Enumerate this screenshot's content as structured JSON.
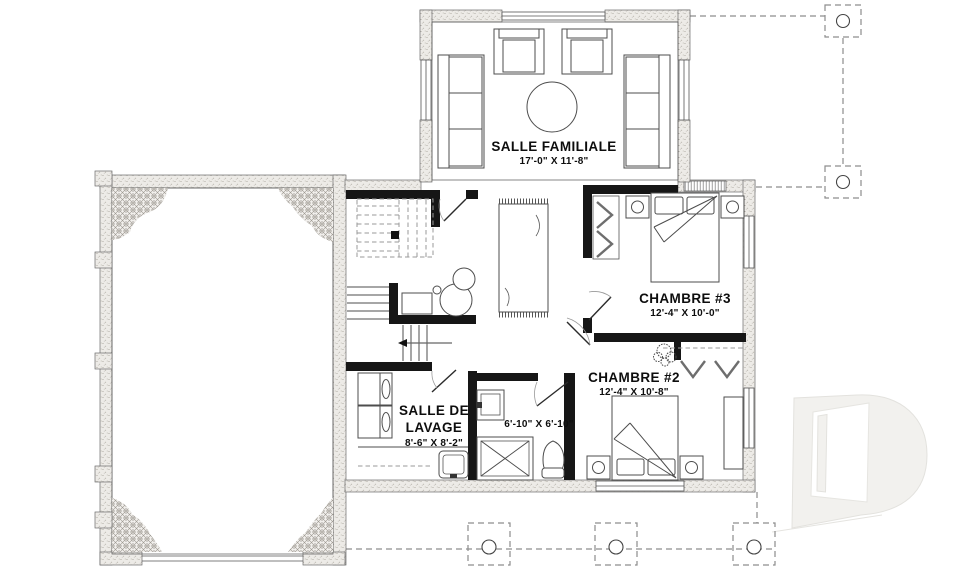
{
  "page": {
    "background": "#ffffff"
  },
  "rooms": {
    "family": {
      "name": "SALLE FAMILIALE",
      "dims": "17'-0\" X 11'-8\""
    },
    "bedroom3": {
      "name": "CHAMBRE #3",
      "dims": "12'-4\" X 10'-0\""
    },
    "bedroom2": {
      "name": "CHAMBRE #2",
      "dims": "12'-4\" X 10'-8\""
    },
    "laundry": {
      "name_line1": "SALLE DE",
      "name_line2": "LAVAGE",
      "dims": "8'-6\" X 8'-2\""
    },
    "bathroom": {
      "dims": "6'-10\" X 6'-10\""
    }
  },
  "colors": {
    "interior_wall": "#161616",
    "exterior_wall_fill": "#edebe7",
    "furniture_line": "#4d4d4d",
    "dashed_deck_line": "#8d8d8d",
    "label_text": "#0d0d0d",
    "logo_watermark": "#f2f1ee"
  }
}
